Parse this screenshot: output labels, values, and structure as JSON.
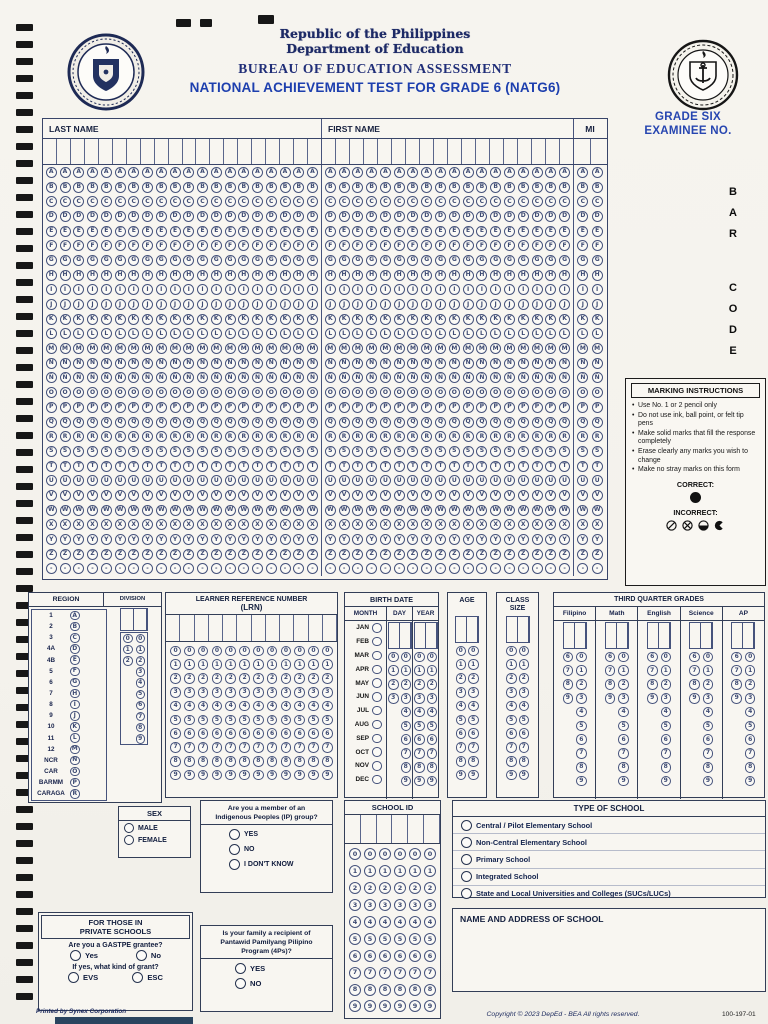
{
  "page": {
    "republic": "Republic of the Philippines",
    "department": "Department of Education",
    "bureau": "BUREAU OF EDUCATION ASSESSMENT",
    "test_title": "NATIONAL ACHIEVEMENT TEST FOR GRADE 6 (NATG6)",
    "examinee_line1": "GRADE SIX",
    "examinee_line2": "EXAMINEE NO.",
    "barcode_letters": [
      "B",
      "A",
      "R",
      "",
      "C",
      "O",
      "D",
      "E"
    ]
  },
  "digits10": [
    "0",
    "1",
    "2",
    "3",
    "4",
    "5",
    "6",
    "7",
    "8",
    "9"
  ],
  "name_grid": {
    "last_name_label": "LAST NAME",
    "first_name_label": "FIRST NAME",
    "mi_label": "MI",
    "last_name_cols": 20,
    "first_name_cols": 18,
    "mi_cols": 2,
    "letters": [
      "A",
      "B",
      "C",
      "D",
      "E",
      "F",
      "G",
      "H",
      "I",
      "J",
      "K",
      "L",
      "M",
      "N",
      "Ñ",
      "O",
      "P",
      "Q",
      "R",
      "S",
      "T",
      "U",
      "V",
      "W",
      "X",
      "Y",
      "Z",
      "-"
    ]
  },
  "marking": {
    "title": "MARKING INSTRUCTIONS",
    "bullets": [
      "Use No. 1 or 2 pencil only",
      "Do not use ink, ball point, or felt tip pens",
      "Make solid marks that fill the response completely",
      "Erase clearly any marks you wish to change",
      "Make no stray marks on this form"
    ],
    "correct_label": "CORRECT:",
    "incorrect_label": "INCORRECT:"
  },
  "region": {
    "title": "REGION",
    "rows": [
      {
        "label": "1",
        "letter": "A"
      },
      {
        "label": "2",
        "letter": "B"
      },
      {
        "label": "3",
        "letter": "C"
      },
      {
        "label": "4A",
        "letter": "D"
      },
      {
        "label": "4B",
        "letter": "E"
      },
      {
        "label": "5",
        "letter": "F"
      },
      {
        "label": "6",
        "letter": "G"
      },
      {
        "label": "7",
        "letter": "H"
      },
      {
        "label": "8",
        "letter": "I"
      },
      {
        "label": "9",
        "letter": "J"
      },
      {
        "label": "10",
        "letter": "K"
      },
      {
        "label": "11",
        "letter": "L"
      },
      {
        "label": "12",
        "letter": "M"
      },
      {
        "label": "NCR",
        "letter": "N"
      },
      {
        "label": "CAR",
        "letter": "O"
      },
      {
        "label": "BARMM",
        "letter": "P"
      },
      {
        "label": "CARAGA",
        "letter": "R"
      }
    ]
  },
  "division": {
    "title": "DIVISION",
    "col1": [
      "0",
      "1",
      "2"
    ]
  },
  "lrn": {
    "title1": "LEARNER REFERENCE NUMBER",
    "title2": "(LRN)",
    "columns": 12
  },
  "birth_date": {
    "title": "BIRTH DATE",
    "month_label": "MONTH",
    "day_label": "DAY",
    "year_label": "YEAR",
    "months": [
      "JAN",
      "FEB",
      "MAR",
      "APR",
      "MAY",
      "JUN",
      "JUL",
      "AUG",
      "SEP",
      "OCT",
      "NOV",
      "DEC"
    ],
    "day_col1": [
      "0",
      "1",
      "2",
      "3"
    ]
  },
  "age": {
    "title": "AGE"
  },
  "class_size": {
    "title1": "CLASS",
    "title2": "SIZE"
  },
  "grades": {
    "title": "THIRD QUARTER GRADES",
    "subjects": [
      "Filipino",
      "Math",
      "English",
      "Science",
      "AP"
    ],
    "tens": [
      "6",
      "7",
      "8",
      "9"
    ]
  },
  "sex": {
    "title": "SEX",
    "options": [
      "MALE",
      "FEMALE"
    ]
  },
  "ip": {
    "q1": "Are you a member of an",
    "q2": "Indigenous Peoples (IP) group?",
    "options": [
      "YES",
      "NO",
      "I DON'T KNOW"
    ]
  },
  "school_id": {
    "title": "SCHOOL ID",
    "columns": 6
  },
  "school_type": {
    "title": "TYPE OF SCHOOL",
    "options": [
      "Central / Pilot Elementary School",
      "Non-Central Elementary School",
      "Primary School",
      "Integrated School",
      "State and Local Universities and Colleges (SUCs/LUCs)"
    ]
  },
  "school_name": {
    "title": "NAME AND ADDRESS OF SCHOOL"
  },
  "private_school": {
    "title1": "FOR THOSE IN",
    "title2": "PRIVATE SCHOOLS",
    "q1": "Are you a GASTPE grantee?",
    "q1_options": [
      "Yes",
      "No"
    ],
    "q2": "If yes, what kind of grant?",
    "q2_options": [
      "EVS",
      "ESC"
    ]
  },
  "pantawid": {
    "q1": "Is your family a recipient of",
    "q2": "Pantawid Pamilyang Pilipino",
    "q3": "Program (4Ps)?",
    "options": [
      "YES",
      "NO"
    ]
  },
  "footer": {
    "printed_by": "Printed by Synex Corporation",
    "copyright": "Copyright © 2023 DepEd - BEA  All rights reserved.",
    "form_no": "100-197-01"
  },
  "colors": {
    "ink": "#46537c",
    "navy": "#1c2a5e",
    "blue": "#1d3fae",
    "black": "#171717"
  }
}
